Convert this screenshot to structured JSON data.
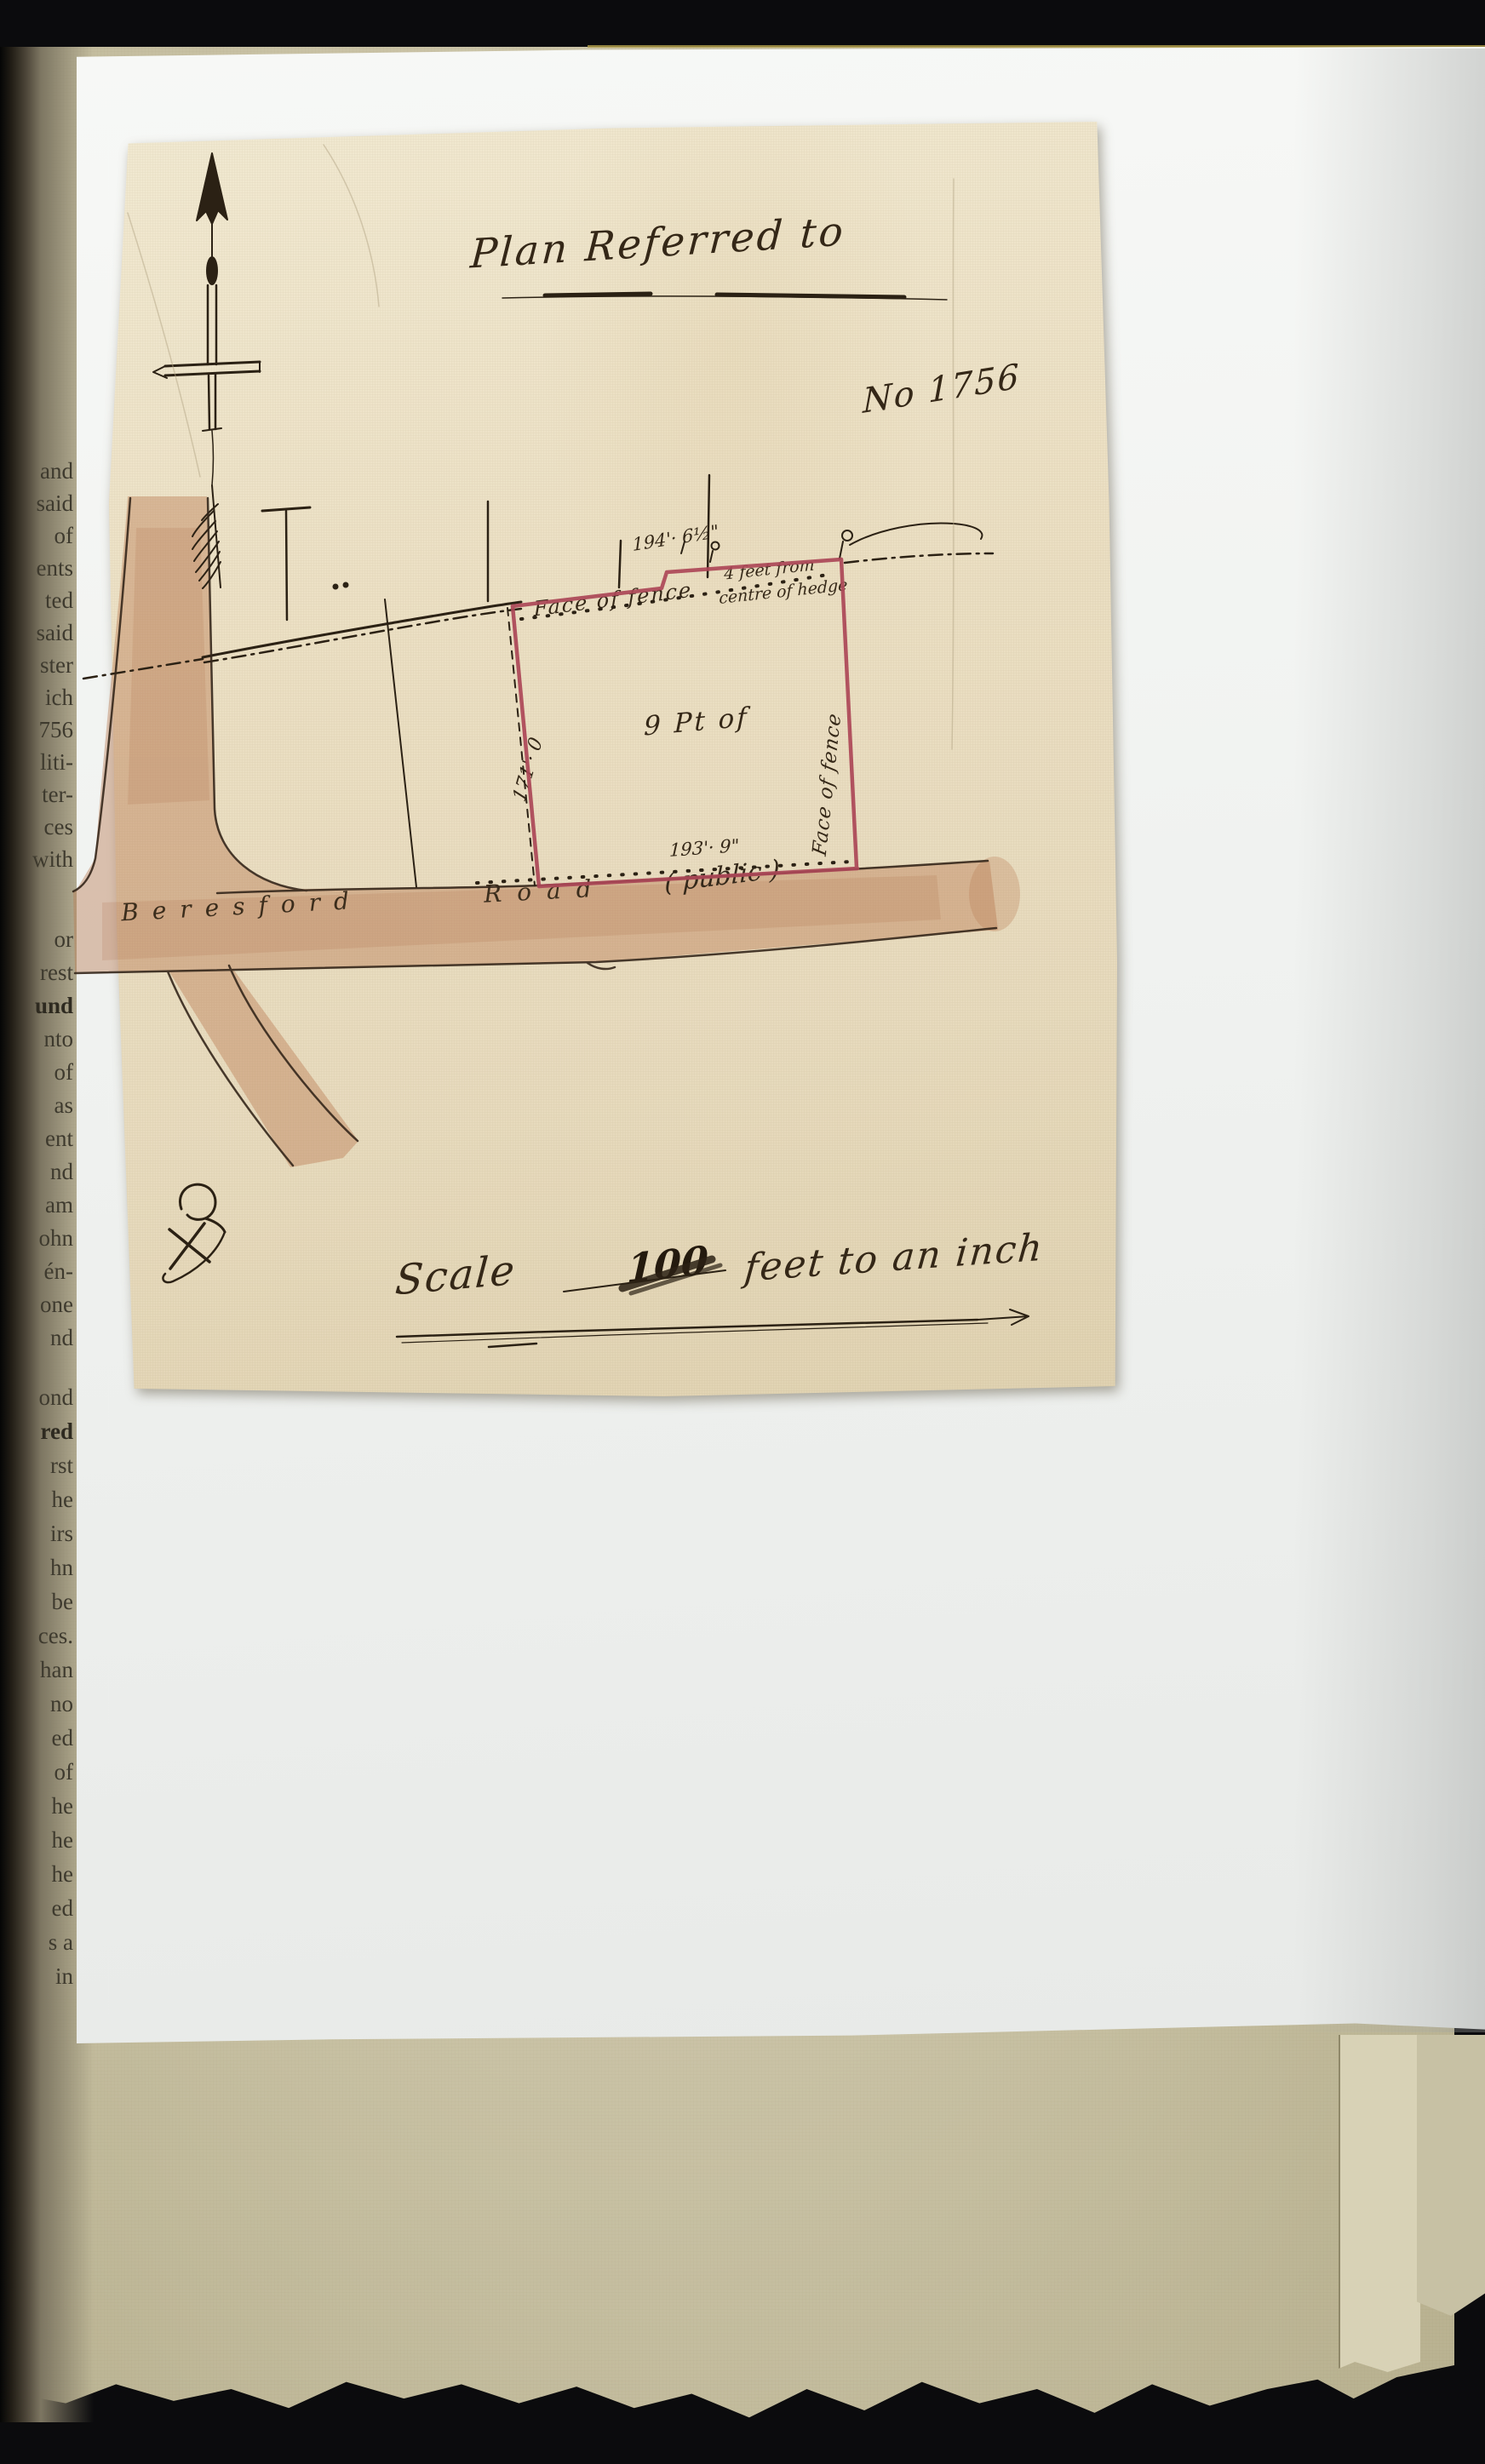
{
  "plan": {
    "title": "Plan Referred to",
    "number": "No 1756",
    "parcel_label": "9 Pt of",
    "dimensions": {
      "top": "194'· 6½\"",
      "left": "171'· 0",
      "bottom": "193'· 9\""
    },
    "fence_labels": {
      "top": "Face of fence",
      "right": "Face of fence"
    },
    "hedge_note_line1": "4 feet from",
    "hedge_note_line2": "centre of hedge",
    "road": {
      "name": "Beresford",
      "word": "Road",
      "qualifier": "( public )"
    },
    "scale": {
      "word": "Scale",
      "struck_value": "100",
      "suffix": "feet to an inch"
    },
    "colors": {
      "plot_outline": "#ac4757",
      "road_wash": "#b97a52",
      "ink": "#2b2114"
    }
  },
  "margin_column": {
    "lines": [
      "and",
      "said",
      "of",
      "ents",
      "ted",
      "said",
      "ster",
      "ich",
      "756",
      "liti-",
      "ter-",
      "ces",
      "with",
      "or",
      "rest",
      "und",
      "nto",
      "of",
      "as",
      "ent",
      "nd",
      "am",
      "ohn",
      "én-",
      "one",
      "nd",
      "ond",
      "red",
      "rst",
      "he",
      "irs",
      "hn",
      "be",
      "ces.",
      "han",
      "no",
      "ed",
      "of",
      "he",
      "he",
      "he",
      "ed",
      "s a",
      "in"
    ]
  }
}
